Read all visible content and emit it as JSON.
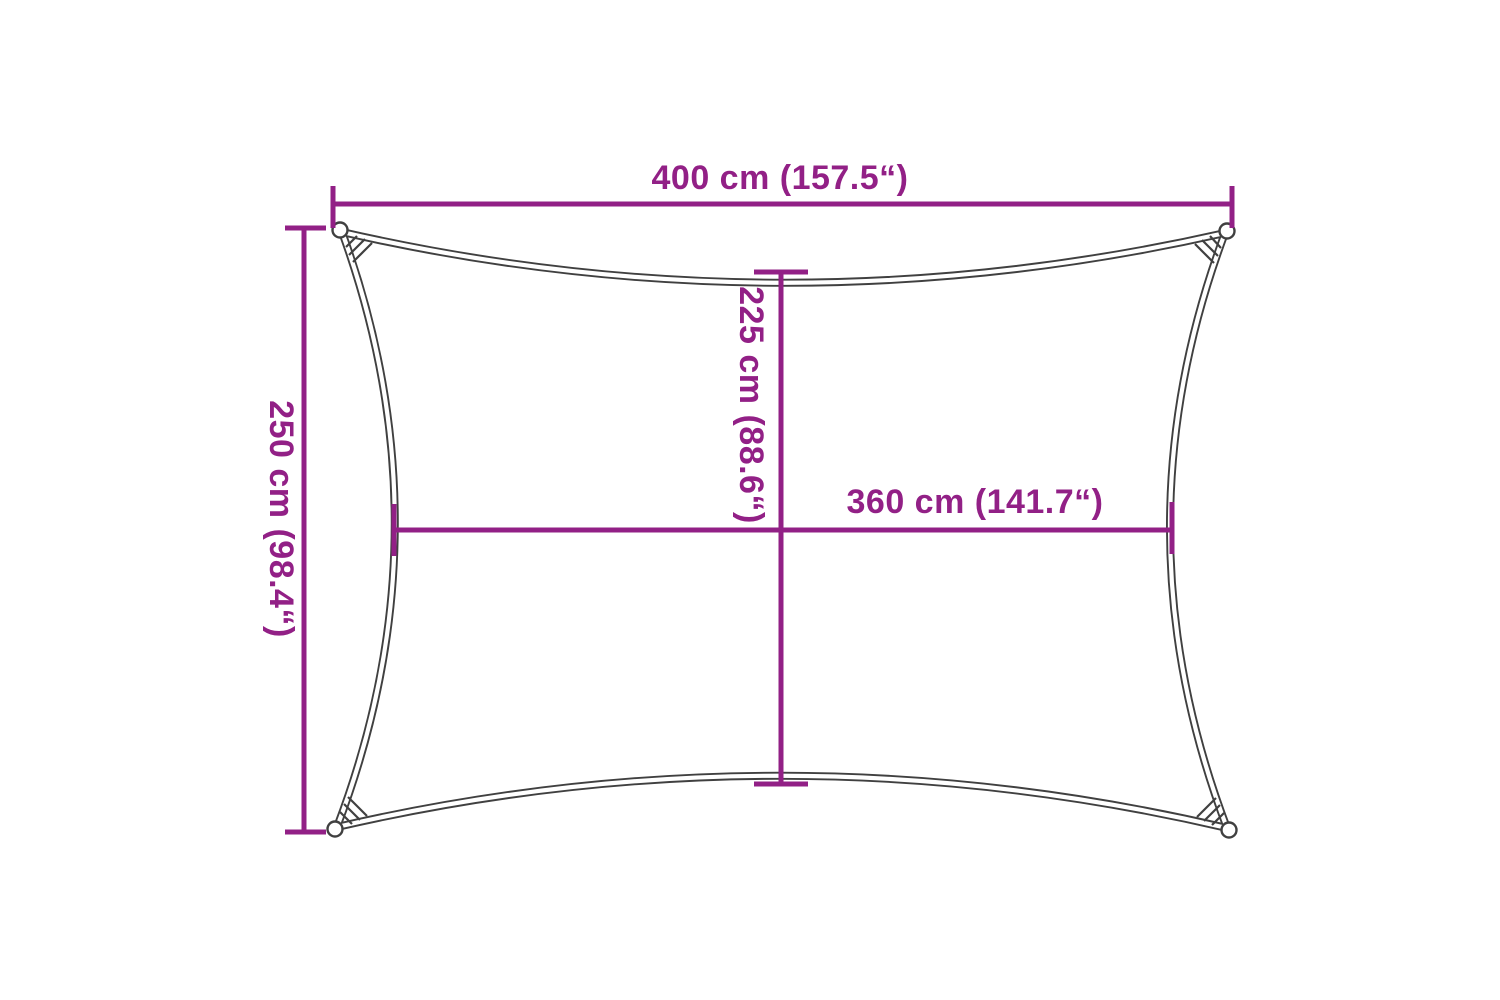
{
  "diagram": {
    "title": "rectangular shade sail dimension diagram",
    "background_color": "#ffffff",
    "colors": {
      "dimension_accent": "#922086",
      "outline_gray": "#404040"
    },
    "dimensions": {
      "top_width": {
        "label": "400 cm (157.5“)",
        "value_cm": 400,
        "value_in": 157.5
      },
      "left_height": {
        "label": "250 cm (98.4“)",
        "value_cm": 250,
        "value_in": 98.4
      },
      "center_height": {
        "label": "225 cm (88.6“)",
        "value_cm": 225,
        "value_in": 88.6
      },
      "center_width": {
        "label": "360 cm (141.7“)",
        "value_cm": 360,
        "value_in": 141.7
      }
    }
  }
}
